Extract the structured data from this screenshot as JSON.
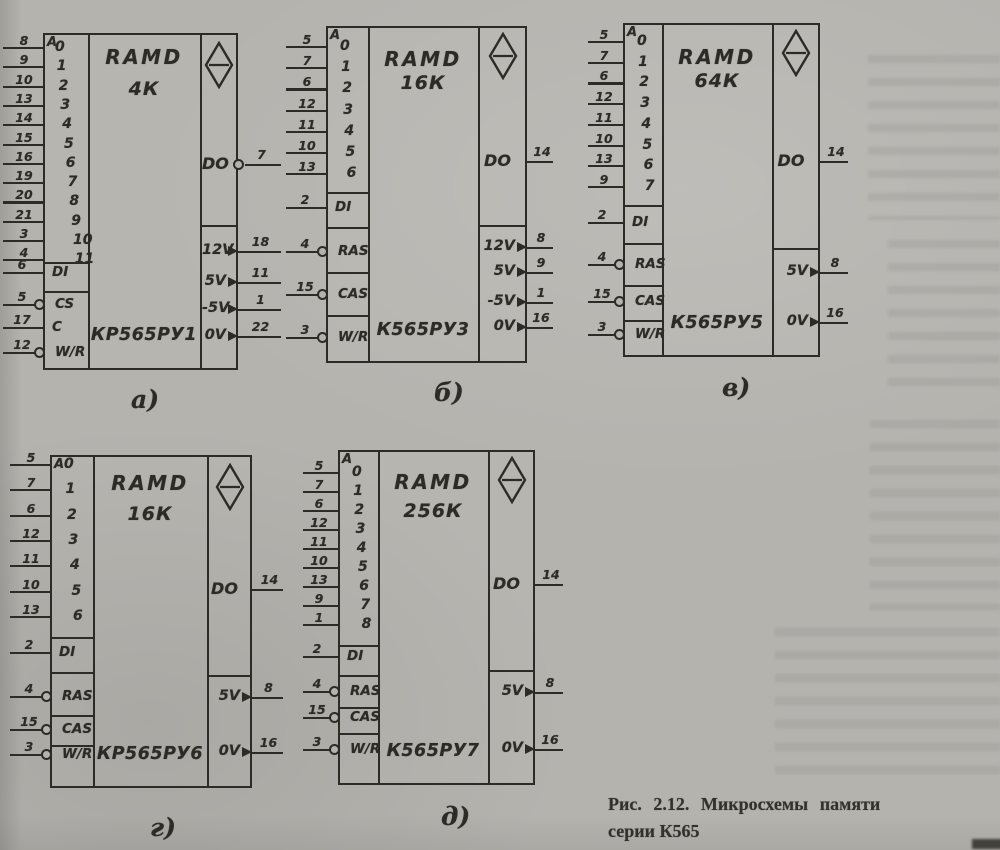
{
  "figure": {
    "caption_line1": "Рис. 2.12. Микросхемы памяти",
    "caption_line2": "серии К565"
  },
  "colors": {
    "paper": "#b5b3ae",
    "ink": "#2d2b26"
  },
  "icons": {
    "memory_symbol": "diamond-with-bar-icon",
    "inverted_pin": "small-circle-icon",
    "power_pin": "right-arrowhead-icon"
  },
  "chips": [
    {
      "id": "a",
      "fig_label": "а)",
      "family": "RAMD",
      "capacity": "4К",
      "part": "КР565РУ1",
      "block": "A",
      "addr": [
        {
          "idx": "0",
          "pin": "8"
        },
        {
          "idx": "1",
          "pin": "9"
        },
        {
          "idx": "2",
          "pin": "10"
        },
        {
          "idx": "3",
          "pin": "13"
        },
        {
          "idx": "4",
          "pin": "14"
        },
        {
          "idx": "5",
          "pin": "15"
        },
        {
          "idx": "6",
          "pin": "16"
        },
        {
          "idx": "7",
          "pin": "19"
        },
        {
          "idx": "8",
          "pin": "20"
        },
        {
          "idx": "9",
          "pin": "21"
        },
        {
          "idx": "10",
          "pin": "3"
        },
        {
          "idx": "11",
          "pin": "4"
        }
      ],
      "ctrl": [
        {
          "label": "DI",
          "pin": "6",
          "circle": false
        },
        {
          "label": "CS",
          "pin": "5",
          "circle": true
        },
        {
          "label": "C",
          "pin": "17",
          "circle": false
        },
        {
          "label": "W/R",
          "pin": "12",
          "circle": true
        }
      ],
      "out": {
        "label": "DO",
        "pin": "7",
        "circle": true
      },
      "power": [
        {
          "label": "12V",
          "pin": "18"
        },
        {
          "label": "5V",
          "pin": "11"
        },
        {
          "label": "-5V",
          "pin": "1"
        },
        {
          "label": "0V",
          "pin": "22"
        }
      ]
    },
    {
      "id": "b",
      "fig_label": "б)",
      "family": "RAMD",
      "capacity": "16К",
      "part": "К565РУ3",
      "block": "A",
      "addr": [
        {
          "idx": "0",
          "pin": "5"
        },
        {
          "idx": "1",
          "pin": "7"
        },
        {
          "idx": "2",
          "pin": "6"
        },
        {
          "idx": "3",
          "pin": "12"
        },
        {
          "idx": "4",
          "pin": "11"
        },
        {
          "idx": "5",
          "pin": "10"
        },
        {
          "idx": "6",
          "pin": "13"
        }
      ],
      "ctrl": [
        {
          "label": "DI",
          "pin": "2",
          "circle": false
        },
        {
          "label": "RAS",
          "pin": "4",
          "circle": true
        },
        {
          "label": "CAS",
          "pin": "15",
          "circle": true
        },
        {
          "label": "W/R",
          "pin": "3",
          "circle": true
        }
      ],
      "out": {
        "label": "DO",
        "pin": "14",
        "circle": false
      },
      "power": [
        {
          "label": "12V",
          "pin": "8"
        },
        {
          "label": "5V",
          "pin": "9"
        },
        {
          "label": "-5V",
          "pin": "1"
        },
        {
          "label": "0V",
          "pin": "16"
        }
      ]
    },
    {
      "id": "v",
      "fig_label": "в)",
      "family": "RAMD",
      "capacity": "64К",
      "part": "К565РУ5",
      "block": "A",
      "addr": [
        {
          "idx": "0",
          "pin": "5"
        },
        {
          "idx": "1",
          "pin": "7"
        },
        {
          "idx": "2",
          "pin": "6"
        },
        {
          "idx": "3",
          "pin": "12"
        },
        {
          "idx": "4",
          "pin": "11"
        },
        {
          "idx": "5",
          "pin": "10"
        },
        {
          "idx": "6",
          "pin": "13"
        },
        {
          "idx": "7",
          "pin": "9"
        }
      ],
      "ctrl": [
        {
          "label": "DI",
          "pin": "2",
          "circle": false
        },
        {
          "label": "RAS",
          "pin": "4",
          "circle": true
        },
        {
          "label": "CAS",
          "pin": "15",
          "circle": true
        },
        {
          "label": "W/R",
          "pin": "3",
          "circle": true
        }
      ],
      "out": {
        "label": "DO",
        "pin": "14",
        "circle": false
      },
      "power": [
        {
          "label": "5V",
          "pin": "8"
        },
        {
          "label": "0V",
          "pin": "16"
        }
      ]
    },
    {
      "id": "g",
      "fig_label": "г)",
      "family": "RAMD",
      "capacity": "16К",
      "part": "КР565РУ6",
      "block": "A",
      "addr": [
        {
          "idx": "0",
          "pin": "5"
        },
        {
          "idx": "1",
          "pin": "7"
        },
        {
          "idx": "2",
          "pin": "6"
        },
        {
          "idx": "3",
          "pin": "12"
        },
        {
          "idx": "4",
          "pin": "11"
        },
        {
          "idx": "5",
          "pin": "10"
        },
        {
          "idx": "6",
          "pin": "13"
        }
      ],
      "ctrl": [
        {
          "label": "DI",
          "pin": "2",
          "circle": false
        },
        {
          "label": "RAS",
          "pin": "4",
          "circle": true
        },
        {
          "label": "CAS",
          "pin": "15",
          "circle": true
        },
        {
          "label": "W/R",
          "pin": "3",
          "circle": true
        }
      ],
      "out": {
        "label": "DO",
        "pin": "14",
        "circle": false
      },
      "power": [
        {
          "label": "5V",
          "pin": "8"
        },
        {
          "label": "0V",
          "pin": "16"
        }
      ]
    },
    {
      "id": "d",
      "fig_label": "д)",
      "family": "RAMD",
      "capacity": "256К",
      "part": "К565РУ7",
      "block": "A",
      "addr": [
        {
          "idx": "0",
          "pin": "5"
        },
        {
          "idx": "1",
          "pin": "7"
        },
        {
          "idx": "2",
          "pin": "6"
        },
        {
          "idx": "3",
          "pin": "12"
        },
        {
          "idx": "4",
          "pin": "11"
        },
        {
          "idx": "5",
          "pin": "10"
        },
        {
          "idx": "6",
          "pin": "13"
        },
        {
          "idx": "7",
          "pin": "9"
        },
        {
          "idx": "8",
          "pin": "1"
        }
      ],
      "ctrl": [
        {
          "label": "DI",
          "pin": "2",
          "circle": false
        },
        {
          "label": "RAS",
          "pin": "4",
          "circle": true
        },
        {
          "label": "CAS",
          "pin": "15",
          "circle": true
        },
        {
          "label": "W/R",
          "pin": "3",
          "circle": true
        }
      ],
      "out": {
        "label": "DO",
        "pin": "14",
        "circle": false
      },
      "power": [
        {
          "label": "5V",
          "pin": "8"
        },
        {
          "label": "0V",
          "pin": "16"
        }
      ]
    }
  ]
}
